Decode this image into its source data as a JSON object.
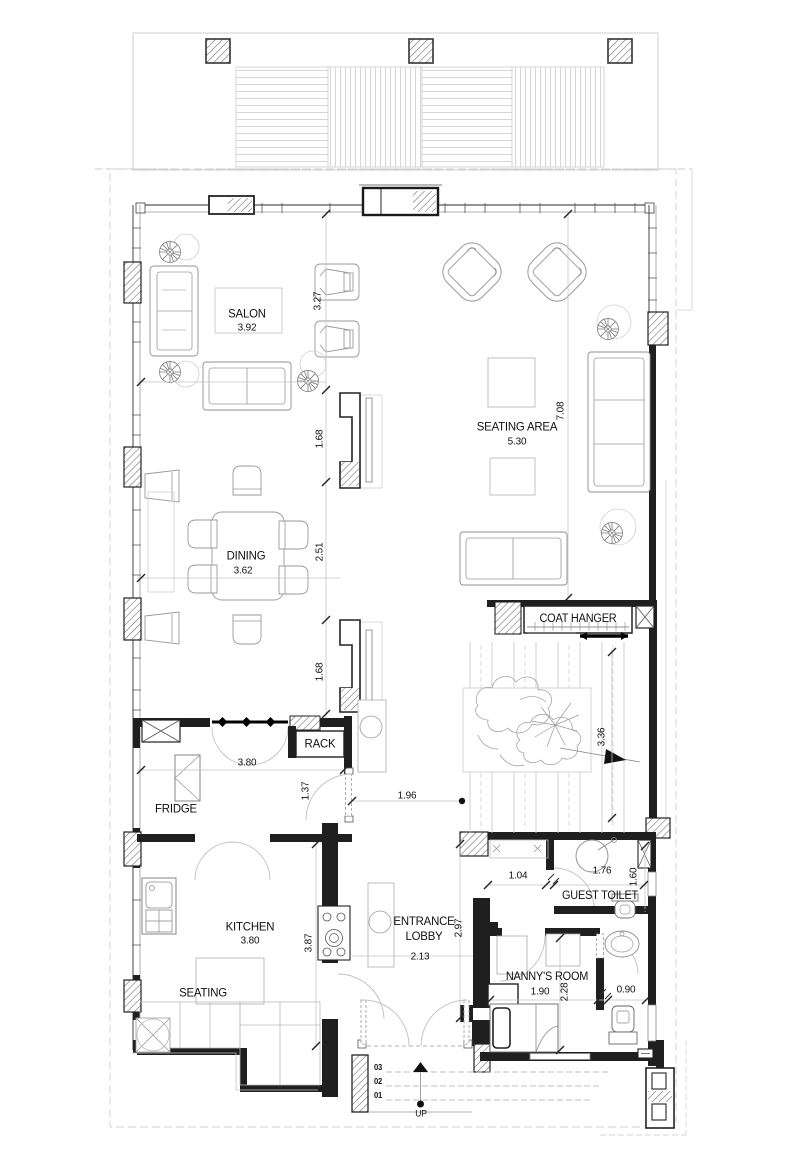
{
  "plan": {
    "rooms": {
      "salon": {
        "name": "SALON",
        "width": "3.92"
      },
      "seating_area": {
        "name": "SEATING AREA",
        "width": "5.30"
      },
      "dining": {
        "name": "DINING",
        "width": "3.62"
      },
      "kitchen": {
        "name": "KITCHEN",
        "width": "3.80"
      },
      "kitchen_seating": {
        "name": "SEATING"
      },
      "entrance_lobby": {
        "name": "ENTRANCE LOBBY",
        "width": "2.13"
      },
      "guest_toilet": {
        "name": "GUEST TOILET"
      },
      "nannys_room": {
        "name": "NANNY'S ROOM",
        "width": "1.90"
      }
    },
    "fixtures": {
      "coat_hanger": "COAT HANGER",
      "rack": "RACK",
      "fridge": "FRIDGE"
    },
    "dimensions": {
      "salon_depth": "3.27",
      "tv_wall_upper": "1.68",
      "dining_depth": "2.51",
      "tv_wall_lower": "1.68",
      "seating_area_depth": "7.08",
      "stair_run": "3.36",
      "pantry_door": "1.37",
      "hall_passage": "1.96",
      "kitchen_door": "3.80",
      "kitchen_depth": "3.87",
      "lobby_depth": "2.97",
      "corridor_width": "1.04",
      "guest_toilet_width": "1.76",
      "guest_toilet_depth": "1.60",
      "nanny_depth": "2.28",
      "nanny_bath_width": "0.90"
    },
    "entrance_steps": {
      "step3": "03",
      "step2": "02",
      "step1": "01",
      "direction": "UP"
    },
    "colors": {
      "background": "#ffffff",
      "wall": "#1f1f1f",
      "light_line": "#c4c4c4",
      "furniture_line": "#9a9a9a",
      "text": "#111111"
    }
  }
}
